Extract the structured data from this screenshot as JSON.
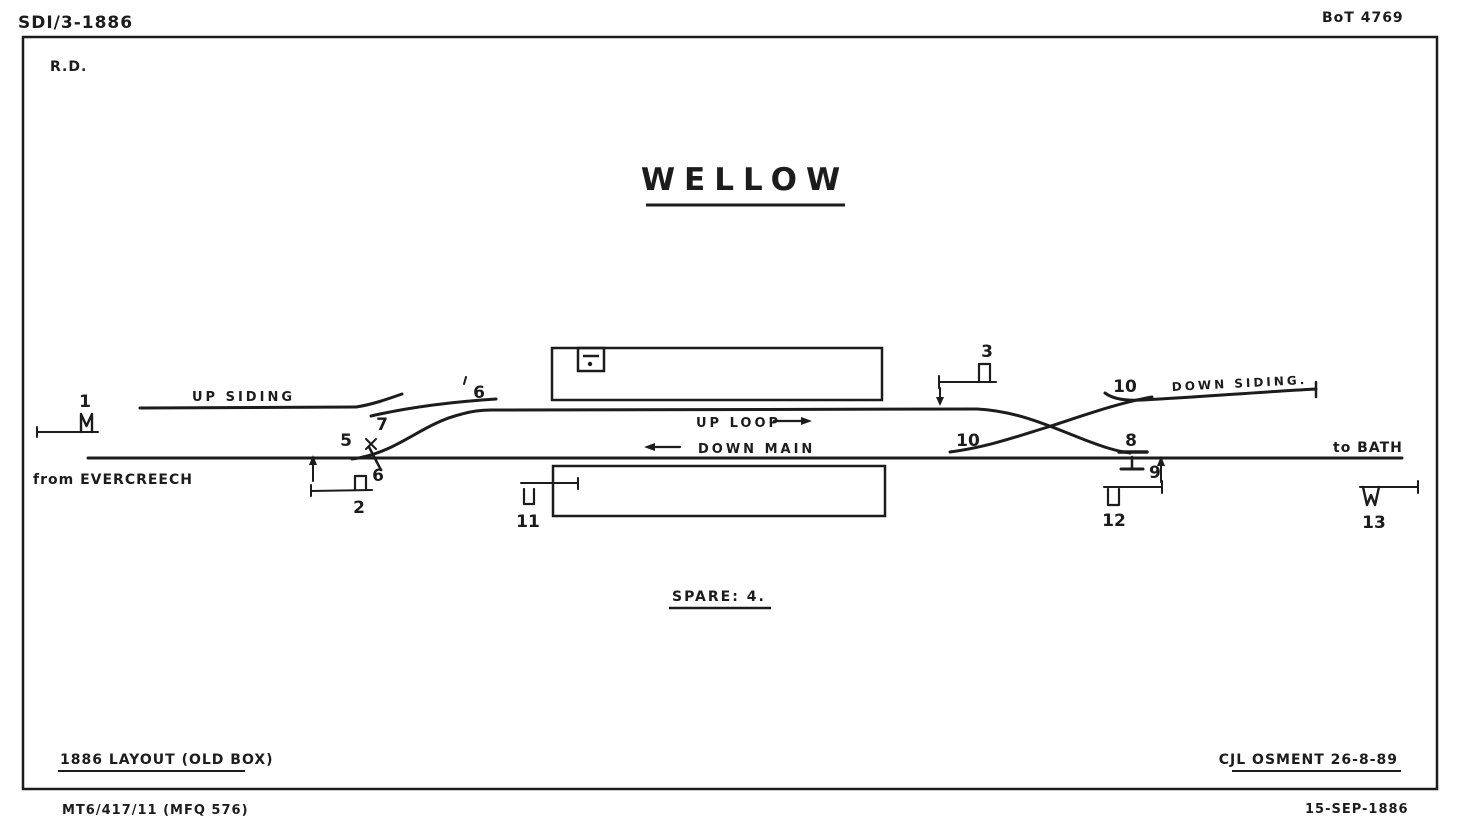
{
  "header": {
    "drawing_no": "SDI/3-1886",
    "bot_ref": "BoT 4769",
    "initials": "R.D."
  },
  "title": "WELLOW",
  "diagram": {
    "labels": {
      "up_siding": "UP SIDING",
      "up_loop": "UP LOOP",
      "down_main": "DOWN MAIN",
      "down_siding": "DOWN SIDING.",
      "from_direction": "from EVERCREECH",
      "to_direction": "to BATH"
    },
    "signals": {
      "s1": "1",
      "s2": "2",
      "s3": "3",
      "s5": "5",
      "s6_lower": "6",
      "s6_upper": "6",
      "s7": "7",
      "s8": "8",
      "s9": "9",
      "s10_left": "10",
      "s10_right": "10",
      "s11": "11",
      "s12": "12",
      "s13": "13"
    },
    "spare_note": "SPARE: 4."
  },
  "footer": {
    "layout_note": "1886 LAYOUT (OLD BOX)",
    "signature": "CJL OSMENT 26-8-89",
    "reference": "MT6/417/11 (MFQ 576)",
    "date": "15-SEP-1886"
  },
  "colors": {
    "ink": "#1c1c1c",
    "paper": "#ffffff"
  }
}
